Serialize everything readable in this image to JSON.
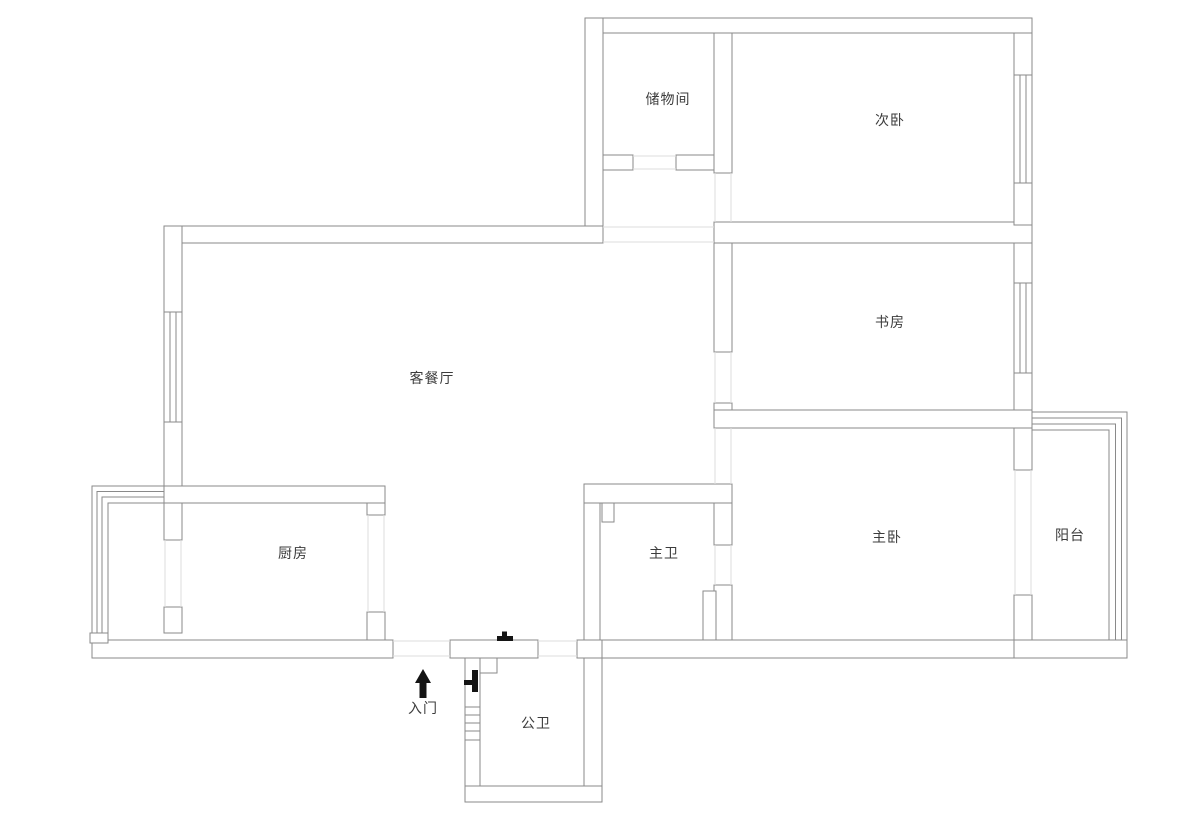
{
  "meta": {
    "type": "floor-plan",
    "language": "zh-CN"
  },
  "colors": {
    "background": "#ffffff",
    "wall_line": "#8a8a8a",
    "opening_line": "#dedede",
    "label_text": "#3c3c3c",
    "symbol": "#141414"
  },
  "rooms": [
    {
      "id": "storage",
      "label": "储物间"
    },
    {
      "id": "secondary-bedroom",
      "label": "次卧"
    },
    {
      "id": "study",
      "label": "书房"
    },
    {
      "id": "living-dining",
      "label": "客餐厅"
    },
    {
      "id": "kitchen",
      "label": "厨房"
    },
    {
      "id": "master-bathroom",
      "label": "主卫"
    },
    {
      "id": "master-bedroom",
      "label": "主卧"
    },
    {
      "id": "balcony",
      "label": "阳台"
    },
    {
      "id": "public-bathroom",
      "label": "公卫"
    }
  ],
  "entrance": {
    "label": "入门",
    "icon": "arrow-up"
  }
}
